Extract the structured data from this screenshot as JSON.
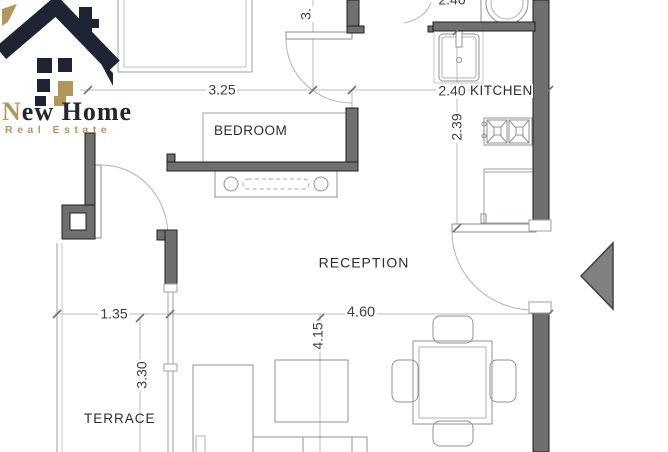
{
  "logo": {
    "brand_initial": "N",
    "brand_rest": "ew Home",
    "tagline": "Real Estate"
  },
  "rooms": {
    "bedroom": "BEDROOM",
    "kitchen": "KITCHEN",
    "reception": "RECEPTION",
    "terrace": "TERRACE"
  },
  "dimensions": {
    "bedroom_width": "3.25",
    "kitchen_width": "2.40",
    "kitchen_depth": "2.39",
    "bath_width_partial": "2.40",
    "bath_depth_partial": "3.",
    "terrace_width": "1.35",
    "terrace_depth": "3.30",
    "reception_width": "4.60",
    "reception_depth": "4.15"
  },
  "colors": {
    "wall_fill": "#6f6f6f",
    "logo_navy": "#1e2434",
    "logo_gold": "#b3965a",
    "drawing_line": "#8f9296",
    "dimension_line": "#b9bcbe"
  }
}
